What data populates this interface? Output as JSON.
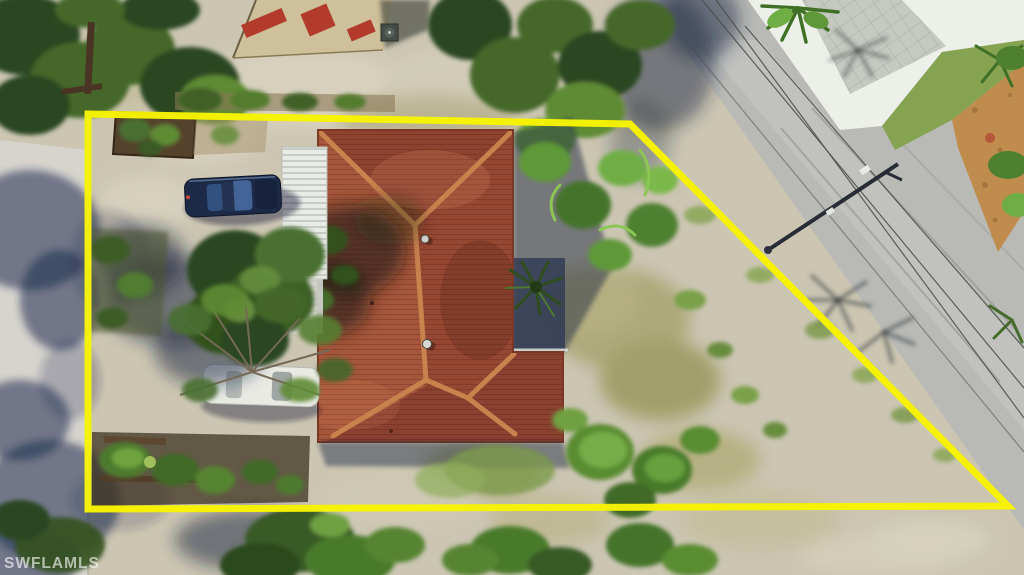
{
  "meta": {
    "description": "Aerial drone photo of a residential corner lot with a yellow property boundary outline, terracotta-roof house, carport, two parked cars, gravel yard, trees and adjacent roads",
    "width": 1024,
    "height": 575
  },
  "watermark": {
    "text": "SWFLAMLS"
  },
  "boundary": {
    "color": "#F7F400",
    "points": "88,114 630,124 1008,506 88,509",
    "stroke_width": 7
  },
  "colors": {
    "gravel_base": "#cbc5b2",
    "road_left": "#d6d4cd",
    "road_right": "#b9bab6",
    "concrete_pad": "#edefe9",
    "paver_apron": "#c6c8c2",
    "grass_strip": "#86a352",
    "mulch": "#bf8c4e",
    "building_roof": "#cec09a",
    "awning_red": "#b23b2b",
    "roof_base": "#99492f",
    "roof_north": "#8e4330",
    "roof_west": "#a5563b",
    "roof_east": "#964731",
    "roof_south": "#8a4130",
    "ridge_cap": "#c8824e",
    "carport_white": "#e9ebe6",
    "car_blue": "#1c2a47",
    "car_white": "#e9eae4",
    "shadow_blue": "rgba(26,36,64,0.5)"
  }
}
